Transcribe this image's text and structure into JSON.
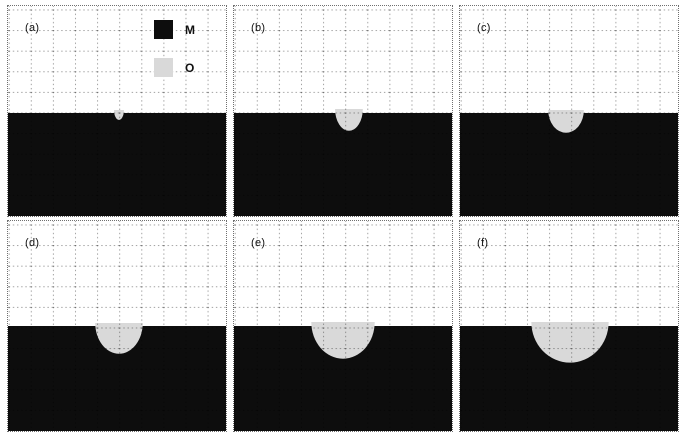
{
  "figure": {
    "colors": {
      "metal": "#0d0d0d",
      "oxide": "#d9d9d9",
      "background": "#ffffff",
      "grid_line": "rgba(0,0,0,0.38)"
    },
    "legend": {
      "items": [
        {
          "id": "metal",
          "label": "M",
          "color": "#0d0d0d"
        },
        {
          "id": "oxide",
          "label": "O",
          "color": "#d9d9d9"
        }
      ]
    },
    "layout": {
      "panel_width": 220,
      "panel_height": 212,
      "col_lefts": [
        7,
        233,
        459
      ],
      "row_tops": [
        5,
        220
      ]
    },
    "panels": [
      {
        "label": "(a)",
        "row": 0,
        "col": 0,
        "interface_y": 108,
        "blob": {
          "cx": 112,
          "rx": 5,
          "depth": 7,
          "protrude": 3
        },
        "has_legend": true
      },
      {
        "label": "(b)",
        "row": 0,
        "col": 1,
        "interface_y": 108,
        "blob": {
          "cx": 116,
          "rx": 14,
          "depth": 18,
          "protrude": 4
        },
        "has_legend": false
      },
      {
        "label": "(c)",
        "row": 0,
        "col": 2,
        "interface_y": 108,
        "blob": {
          "cx": 107,
          "rx": 18,
          "depth": 20,
          "protrude": 3
        },
        "has_legend": false
      },
      {
        "label": "(d)",
        "row": 1,
        "col": 0,
        "interface_y": 106,
        "blob": {
          "cx": 112,
          "rx": 24,
          "depth": 28,
          "protrude": 3
        },
        "has_legend": false
      },
      {
        "label": "(e)",
        "row": 1,
        "col": 1,
        "interface_y": 106,
        "blob": {
          "cx": 110,
          "rx": 32,
          "depth": 33,
          "protrude": 4
        },
        "has_legend": false
      },
      {
        "label": "(f)",
        "row": 1,
        "col": 2,
        "interface_y": 106,
        "blob": {
          "cx": 111,
          "rx": 39,
          "depth": 37,
          "protrude": 4
        },
        "has_legend": false
      }
    ]
  }
}
